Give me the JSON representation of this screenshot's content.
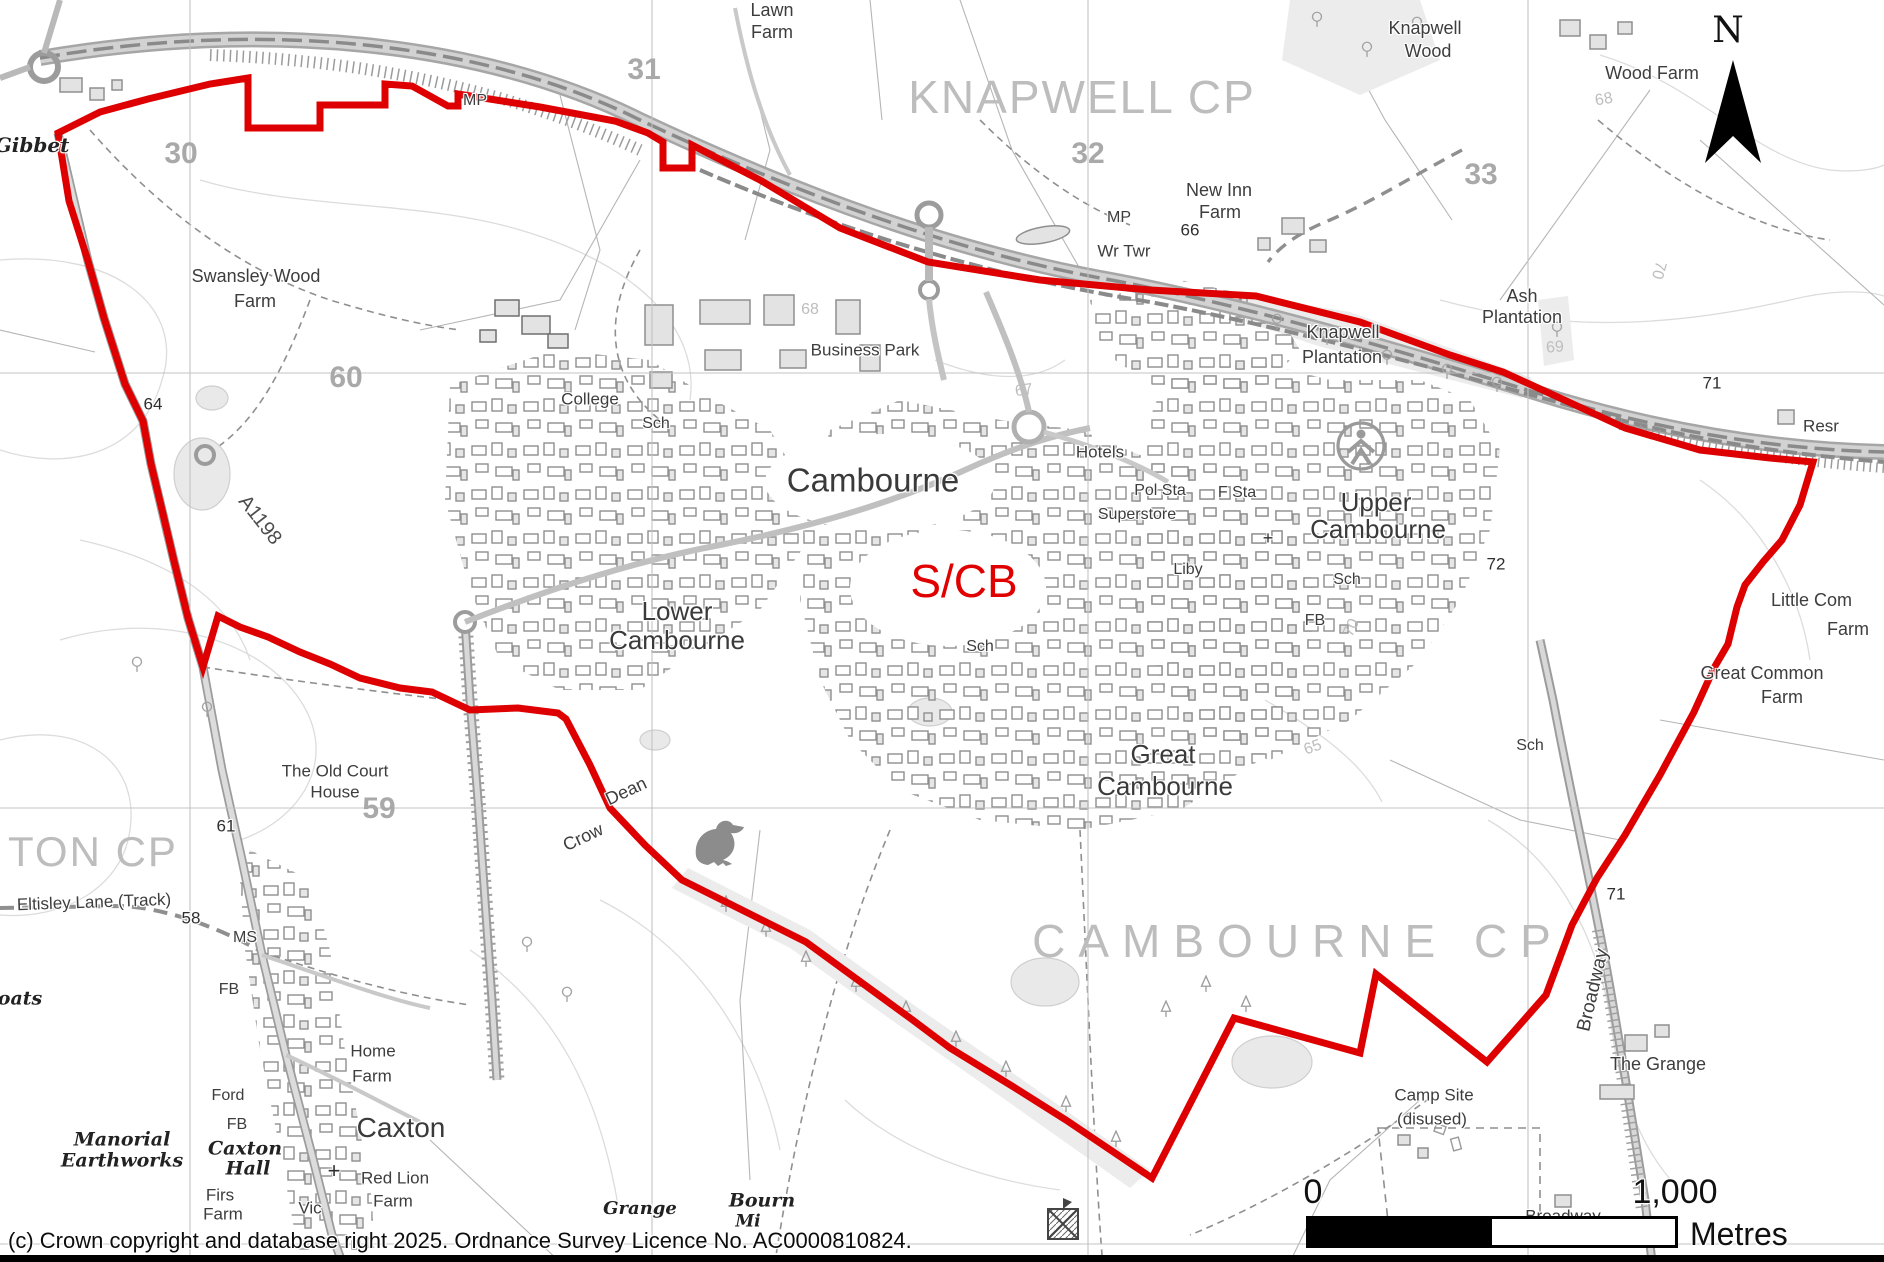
{
  "boundary": {
    "name": "S/CB settlement boundary",
    "color": "#de0000",
    "points": [
      [
        58,
        133
      ],
      [
        100,
        112
      ],
      [
        148,
        99
      ],
      [
        210,
        84
      ],
      [
        248,
        78
      ],
      [
        248,
        128
      ],
      [
        320,
        128
      ],
      [
        320,
        105
      ],
      [
        385,
        105
      ],
      [
        385,
        84
      ],
      [
        412,
        86
      ],
      [
        448,
        106
      ],
      [
        458,
        106
      ],
      [
        458,
        94
      ],
      [
        540,
        107
      ],
      [
        615,
        121
      ],
      [
        648,
        133
      ],
      [
        663,
        142
      ],
      [
        663,
        168
      ],
      [
        692,
        168
      ],
      [
        692,
        145
      ],
      [
        760,
        180
      ],
      [
        840,
        228
      ],
      [
        928,
        262
      ],
      [
        1040,
        280
      ],
      [
        1150,
        290
      ],
      [
        1256,
        296
      ],
      [
        1360,
        322
      ],
      [
        1450,
        355
      ],
      [
        1503,
        372
      ],
      [
        1560,
        398
      ],
      [
        1625,
        428
      ],
      [
        1700,
        450
      ],
      [
        1770,
        458
      ],
      [
        1813,
        462
      ],
      [
        1800,
        505
      ],
      [
        1782,
        540
      ],
      [
        1763,
        562
      ],
      [
        1745,
        585
      ],
      [
        1737,
        607
      ],
      [
        1728,
        644
      ],
      [
        1714,
        668
      ],
      [
        1694,
        712
      ],
      [
        1660,
        775
      ],
      [
        1625,
        835
      ],
      [
        1597,
        878
      ],
      [
        1572,
        925
      ],
      [
        1546,
        995
      ],
      [
        1487,
        1062
      ],
      [
        1376,
        974
      ],
      [
        1360,
        1053
      ],
      [
        1234,
        1018
      ],
      [
        1152,
        1178
      ],
      [
        1066,
        1120
      ],
      [
        1012,
        1086
      ],
      [
        950,
        1048
      ],
      [
        910,
        1018
      ],
      [
        806,
        942
      ],
      [
        682,
        880
      ],
      [
        645,
        845
      ],
      [
        610,
        808
      ],
      [
        590,
        765
      ],
      [
        566,
        719
      ],
      [
        558,
        713
      ],
      [
        518,
        708
      ],
      [
        470,
        710
      ],
      [
        432,
        692
      ],
      [
        400,
        688
      ],
      [
        360,
        678
      ],
      [
        330,
        664
      ],
      [
        300,
        652
      ],
      [
        268,
        637
      ],
      [
        240,
        627
      ],
      [
        218,
        616
      ],
      [
        203,
        667
      ],
      [
        188,
        618
      ],
      [
        174,
        561
      ],
      [
        163,
        514
      ],
      [
        151,
        464
      ],
      [
        143,
        421
      ],
      [
        125,
        384
      ],
      [
        104,
        318
      ],
      [
        88,
        261
      ],
      [
        69,
        201
      ]
    ]
  },
  "grid": {
    "vertical_x": [
      190,
      652,
      1088,
      1528
    ],
    "horizontal_y": [
      373,
      808,
      1244
    ]
  },
  "north_arrow": {
    "label": "N"
  },
  "scale_bar": {
    "zero": "0",
    "max": "1,000",
    "unit": "Metres"
  },
  "copyright": "(c) Crown copyright and database right 2025. Ordnance Survey Licence No. AC0000810824.",
  "labels": [
    {
      "id": "ton-cp",
      "t": "TON CP",
      "x": 8,
      "y": 852,
      "s": 42,
      "c": "parish",
      "a": "l",
      "ls": 2
    },
    {
      "id": "knapwell-cp",
      "t": "KNAPWELL CP",
      "x": 1082,
      "y": 97,
      "s": 46,
      "c": "parish",
      "ls": 2
    },
    {
      "id": "cambourne-cp",
      "t": "CAMBOURNE CP",
      "x": 1298,
      "y": 941,
      "s": 46,
      "c": "parish",
      "ls": 13
    },
    {
      "id": "cambourne",
      "t": "Cambourne",
      "x": 873,
      "y": 480,
      "s": 33,
      "c": "town"
    },
    {
      "id": "lower-1",
      "t": "Lower",
      "x": 677,
      "y": 611,
      "s": 26,
      "c": "town"
    },
    {
      "id": "lower-2",
      "t": "Cambourne",
      "x": 677,
      "y": 640,
      "s": 26,
      "c": "town"
    },
    {
      "id": "great-1",
      "t": "Great",
      "x": 1163,
      "y": 754,
      "s": 26,
      "c": "town"
    },
    {
      "id": "great-2",
      "t": "Cambourne",
      "x": 1165,
      "y": 786,
      "s": 26,
      "c": "town"
    },
    {
      "id": "upper-1",
      "t": "Upper",
      "x": 1376,
      "y": 502,
      "s": 26,
      "c": "town"
    },
    {
      "id": "upper-2",
      "t": "Cambourne",
      "x": 1378,
      "y": 529,
      "s": 26,
      "c": "town"
    },
    {
      "id": "caxton",
      "t": "Caxton",
      "x": 401,
      "y": 1128,
      "s": 28,
      "c": "town"
    },
    {
      "id": "scb",
      "t": "S/CB",
      "x": 964,
      "y": 581,
      "s": 46,
      "c": "redlbl"
    },
    {
      "id": "lawn-1",
      "t": "Lawn",
      "x": 772,
      "y": 10,
      "s": 18,
      "c": "place"
    },
    {
      "id": "lawn-2",
      "t": "Farm",
      "x": 772,
      "y": 32,
      "s": 18,
      "c": "place"
    },
    {
      "id": "knapwood-1",
      "t": "Knapwell",
      "x": 1425,
      "y": 28,
      "s": 18,
      "c": "place"
    },
    {
      "id": "knapwood-2",
      "t": "Wood",
      "x": 1428,
      "y": 51,
      "s": 18,
      "c": "place"
    },
    {
      "id": "wood-farm",
      "t": "Wood Farm",
      "x": 1652,
      "y": 73,
      "s": 18,
      "c": "place"
    },
    {
      "id": "newinn-1",
      "t": "New Inn",
      "x": 1219,
      "y": 190,
      "s": 18,
      "c": "place"
    },
    {
      "id": "newinn-2",
      "t": "Farm",
      "x": 1220,
      "y": 212,
      "s": 18,
      "c": "place"
    },
    {
      "id": "swansley-1",
      "t": "Swansley Wood",
      "x": 256,
      "y": 276,
      "s": 18,
      "c": "place"
    },
    {
      "id": "swansley-2",
      "t": "Farm",
      "x": 255,
      "y": 301,
      "s": 18,
      "c": "place"
    },
    {
      "id": "ash-1",
      "t": "Ash",
      "x": 1522,
      "y": 296,
      "s": 18,
      "c": "place"
    },
    {
      "id": "ash-2",
      "t": "Plantation",
      "x": 1522,
      "y": 317,
      "s": 18,
      "c": "place"
    },
    {
      "id": "knapplant-1",
      "t": "Knapwell",
      "x": 1343,
      "y": 332,
      "s": 18,
      "c": "place"
    },
    {
      "id": "knapplant-2",
      "t": "Plantation",
      "x": 1342,
      "y": 357,
      "s": 18,
      "c": "place"
    },
    {
      "id": "business-park",
      "t": "Business Park",
      "x": 865,
      "y": 350,
      "s": 17,
      "c": "place"
    },
    {
      "id": "college",
      "t": "College",
      "x": 590,
      "y": 399,
      "s": 17,
      "c": "place"
    },
    {
      "id": "hotels",
      "t": "Hotels",
      "x": 1100,
      "y": 452,
      "s": 17,
      "c": "place"
    },
    {
      "id": "pol-sta",
      "t": "Pol Sta",
      "x": 1160,
      "y": 491,
      "s": 16,
      "c": "place"
    },
    {
      "id": "f-sta",
      "t": "F Sta",
      "x": 1237,
      "y": 493,
      "s": 16,
      "c": "place"
    },
    {
      "id": "superstore",
      "t": "Superstore",
      "x": 1137,
      "y": 515,
      "s": 16,
      "c": "place"
    },
    {
      "id": "liby",
      "t": "Liby",
      "x": 1188,
      "y": 570,
      "s": 16,
      "c": "place"
    },
    {
      "id": "wr-twr",
      "t": "Wr Twr",
      "x": 1124,
      "y": 251,
      "s": 17,
      "c": "place"
    },
    {
      "id": "mp-1",
      "t": "MP",
      "x": 475,
      "y": 101,
      "s": 16,
      "c": "place"
    },
    {
      "id": "mp-2",
      "t": "MP",
      "x": 1119,
      "y": 218,
      "s": 16,
      "c": "place"
    },
    {
      "id": "resr",
      "t": "Resr",
      "x": 1821,
      "y": 426,
      "s": 17,
      "c": "place"
    },
    {
      "id": "littlecom-1",
      "t": "Little Com",
      "x": 1771,
      "y": 600,
      "s": 18,
      "c": "place",
      "a": "l"
    },
    {
      "id": "littlecom-2",
      "t": "Farm",
      "x": 1848,
      "y": 629,
      "s": 18,
      "c": "place"
    },
    {
      "id": "greatcommon-1",
      "t": "Great Common",
      "x": 1762,
      "y": 673,
      "s": 18,
      "c": "place"
    },
    {
      "id": "greatcommon-2",
      "t": "Farm",
      "x": 1782,
      "y": 697,
      "s": 18,
      "c": "place"
    },
    {
      "id": "the-grange",
      "t": "The Grange",
      "x": 1658,
      "y": 1064,
      "s": 18,
      "c": "place"
    },
    {
      "id": "campsite-1",
      "t": "Camp Site",
      "x": 1434,
      "y": 1095,
      "s": 17,
      "c": "place"
    },
    {
      "id": "campsite-2",
      "t": "(disused)",
      "x": 1432,
      "y": 1119,
      "s": 17,
      "c": "place"
    },
    {
      "id": "broadwayfarm-1",
      "t": "Broadway",
      "x": 1563,
      "y": 1216,
      "s": 17,
      "c": "place"
    },
    {
      "id": "broadwayfarm-2",
      "t": "Farm",
      "x": 1548,
      "y": 1238,
      "s": 17,
      "c": "place"
    },
    {
      "id": "home-1",
      "t": "Home",
      "x": 373,
      "y": 1051,
      "s": 17,
      "c": "place"
    },
    {
      "id": "home-2",
      "t": "Farm",
      "x": 372,
      "y": 1076,
      "s": 17,
      "c": "place"
    },
    {
      "id": "redlion-1",
      "t": "Red Lion",
      "x": 395,
      "y": 1178,
      "s": 17,
      "c": "place"
    },
    {
      "id": "redlion-2",
      "t": "Farm",
      "x": 393,
      "y": 1201,
      "s": 17,
      "c": "place"
    },
    {
      "id": "vic",
      "t": "Vic",
      "x": 310,
      "y": 1208,
      "s": 17,
      "c": "place"
    },
    {
      "id": "firs-1",
      "t": "Firs",
      "x": 220,
      "y": 1195,
      "s": 17,
      "c": "place"
    },
    {
      "id": "firs-2",
      "t": "Farm",
      "x": 223,
      "y": 1214,
      "s": 17,
      "c": "place"
    },
    {
      "id": "ford",
      "t": "Ford",
      "x": 228,
      "y": 1096,
      "s": 16,
      "c": "place"
    },
    {
      "id": "ms",
      "t": "MS",
      "x": 245,
      "y": 938,
      "s": 16,
      "c": "place"
    },
    {
      "id": "fb-1",
      "t": "FB",
      "x": 229,
      "y": 990,
      "s": 16,
      "c": "place"
    },
    {
      "id": "fb-2",
      "t": "FB",
      "x": 237,
      "y": 1125,
      "s": 16,
      "c": "place"
    },
    {
      "id": "fb-3",
      "t": "FB",
      "x": 1315,
      "y": 621,
      "s": 16,
      "c": "place"
    },
    {
      "id": "sch-1",
      "t": "Sch",
      "x": 656,
      "y": 424,
      "s": 16,
      "c": "place"
    },
    {
      "id": "sch-2",
      "t": "Sch",
      "x": 980,
      "y": 647,
      "s": 16,
      "c": "place"
    },
    {
      "id": "sch-3",
      "t": "Sch",
      "x": 1347,
      "y": 580,
      "s": 16,
      "c": "place"
    },
    {
      "id": "sch-4",
      "t": "Sch",
      "x": 1530,
      "y": 746,
      "s": 16,
      "c": "place"
    },
    {
      "id": "grid-30",
      "t": "30",
      "x": 181,
      "y": 154,
      "s": 30,
      "c": "gridnum"
    },
    {
      "id": "grid-31",
      "t": "31",
      "x": 644,
      "y": 70,
      "s": 30,
      "c": "gridnum"
    },
    {
      "id": "grid-32",
      "t": "32",
      "x": 1088,
      "y": 154,
      "s": 30,
      "c": "gridnum"
    },
    {
      "id": "grid-33",
      "t": "33",
      "x": 1481,
      "y": 175,
      "s": 30,
      "c": "gridnum"
    },
    {
      "id": "grid-60",
      "t": "60",
      "x": 346,
      "y": 378,
      "s": 30,
      "c": "gridnum"
    },
    {
      "id": "grid-59",
      "t": "59",
      "x": 379,
      "y": 809,
      "s": 30,
      "c": "gridnum"
    },
    {
      "id": "spot-64",
      "t": "64",
      "x": 153,
      "y": 404,
      "s": 17,
      "c": "spot"
    },
    {
      "id": "spot-61",
      "t": "61",
      "x": 226,
      "y": 826,
      "s": 17,
      "c": "spot"
    },
    {
      "id": "spot-58",
      "t": "58",
      "x": 191,
      "y": 918,
      "s": 17,
      "c": "spot"
    },
    {
      "id": "spot-66",
      "t": "66",
      "x": 1190,
      "y": 230,
      "s": 17,
      "c": "spot"
    },
    {
      "id": "spot-72",
      "t": "72",
      "x": 1496,
      "y": 564,
      "s": 17,
      "c": "spot"
    },
    {
      "id": "spot-71a",
      "t": "71",
      "x": 1712,
      "y": 383,
      "s": 17,
      "c": "spot"
    },
    {
      "id": "spot-71b",
      "t": "71",
      "x": 1616,
      "y": 894,
      "s": 17,
      "c": "spot"
    },
    {
      "id": "cont-68a",
      "t": "68",
      "x": 810,
      "y": 310,
      "s": 16,
      "c": "contour"
    },
    {
      "id": "cont-67",
      "t": "67",
      "x": 1024,
      "y": 391,
      "s": 16,
      "c": "contour",
      "r": -8
    },
    {
      "id": "cont-65",
      "t": "65",
      "x": 1313,
      "y": 748,
      "s": 16,
      "c": "contour",
      "r": -20
    },
    {
      "id": "cont-70a",
      "t": "70",
      "x": 1352,
      "y": 628,
      "s": 16,
      "c": "contour",
      "r": -65
    },
    {
      "id": "cont-70b",
      "t": "70",
      "x": 1658,
      "y": 270,
      "s": 16,
      "c": "contour",
      "r": 105
    },
    {
      "id": "cont-68b",
      "t": "68",
      "x": 1604,
      "y": 100,
      "s": 16,
      "c": "contour",
      "r": -10
    },
    {
      "id": "cont-69",
      "t": "69",
      "x": 1555,
      "y": 348,
      "s": 16,
      "c": "contour",
      "r": -5
    },
    {
      "id": "road-a1198",
      "t": "A1198",
      "x": 260,
      "y": 520,
      "s": 20,
      "c": "roadnum",
      "r": 52
    },
    {
      "id": "road-broadway",
      "t": "Broadway",
      "x": 1593,
      "y": 990,
      "s": 19,
      "c": "place",
      "r": -77
    },
    {
      "id": "crow-1",
      "t": "Crow",
      "x": 583,
      "y": 837,
      "s": 18,
      "c": "place",
      "r": -25
    },
    {
      "id": "crow-2",
      "t": "Dean",
      "x": 626,
      "y": 791,
      "s": 18,
      "c": "place",
      "r": -25
    },
    {
      "id": "eltisley",
      "t": "Eltisley Lane (Track)",
      "x": 94,
      "y": 902,
      "s": 17,
      "c": "place",
      "r": -2
    },
    {
      "id": "oldcourt-1",
      "t": "The Old Court",
      "x": 335,
      "y": 771,
      "s": 17,
      "c": "place"
    },
    {
      "id": "oldcourt-2",
      "t": "House",
      "x": 335,
      "y": 792,
      "s": 17,
      "c": "place"
    },
    {
      "id": "gibbet",
      "t": "Gibbet",
      "x": 32,
      "y": 145,
      "s": 20,
      "c": "antiq"
    },
    {
      "id": "moats",
      "t": "oats",
      "x": 20,
      "y": 999,
      "s": 19,
      "c": "antiq"
    },
    {
      "id": "manorial-1",
      "t": "Manorial",
      "x": 122,
      "y": 1140,
      "s": 19,
      "c": "antiq"
    },
    {
      "id": "manorial-2",
      "t": "Earthworks",
      "x": 122,
      "y": 1161,
      "s": 19,
      "c": "antiq"
    },
    {
      "id": "caxtonhall-1",
      "t": "Caxton",
      "x": 245,
      "y": 1149,
      "s": 19,
      "c": "antiq"
    },
    {
      "id": "caxtonhall-2",
      "t": "Hall",
      "x": 248,
      "y": 1169,
      "s": 19,
      "c": "antiq"
    },
    {
      "id": "bourn-1",
      "t": "Bourn",
      "x": 762,
      "y": 1201,
      "s": 19,
      "c": "antiq"
    },
    {
      "id": "bourn-2",
      "t": "Mi",
      "x": 748,
      "y": 1222,
      "s": 17,
      "c": "antiq"
    },
    {
      "id": "grange",
      "t": "Grange",
      "x": 640,
      "y": 1209,
      "s": 18,
      "c": "antiq"
    },
    {
      "id": "cross-caxton",
      "t": "+",
      "x": 334,
      "y": 1171,
      "s": 22,
      "c": "spot"
    },
    {
      "id": "cross-upper",
      "t": "+",
      "x": 1268,
      "y": 538,
      "s": 18,
      "c": "spot"
    }
  ]
}
